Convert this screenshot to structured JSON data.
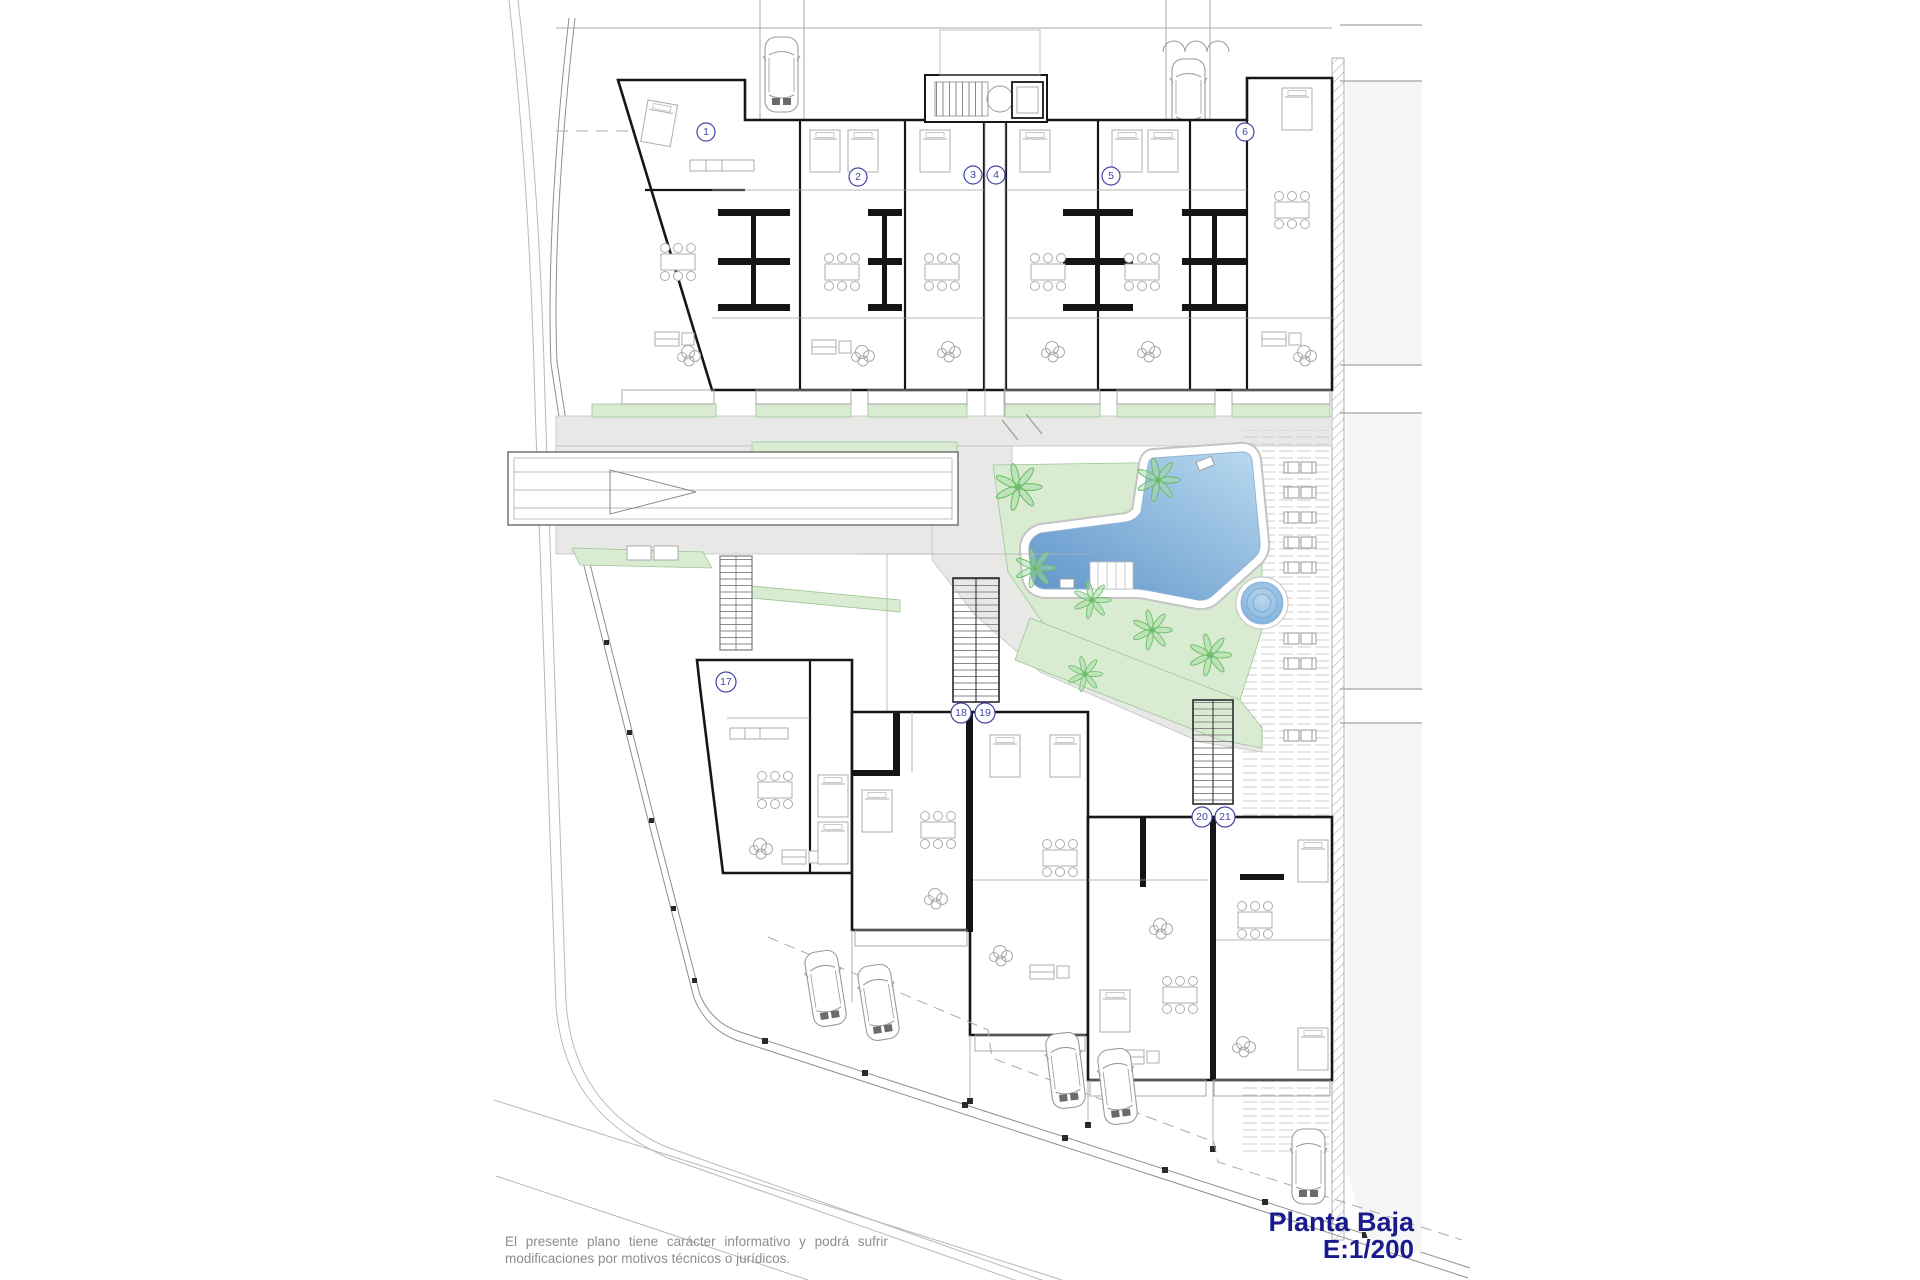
{
  "plan": {
    "title": "Planta Baja",
    "scale": "E:1/200"
  },
  "disclaimer": {
    "line1": "El presente plano tiene carácter informativo y podrá sufrir",
    "line2": "modificaciones por motivos técnicos o jurídicos."
  },
  "unit_labels": {
    "top": [
      "1",
      "2",
      "3",
      "4",
      "5",
      "6"
    ],
    "bottom": [
      "17",
      "18",
      "19",
      "20",
      "21"
    ]
  },
  "colors": {
    "title_navy": "#1a1a8c",
    "path_gray": "#e8e9e7",
    "terrace_green": "#d9ecd2",
    "green_border": "#9cc695",
    "palm_green": "#7cc978",
    "pool_blue_light": "#b9d9ef",
    "pool_blue_dark": "#5e93c9",
    "wall_black": "#1a1a1a",
    "furniture_gray": "#adadad",
    "boundary_gray": "#9a9a9a",
    "band_gray": "#f6f6f6"
  }
}
